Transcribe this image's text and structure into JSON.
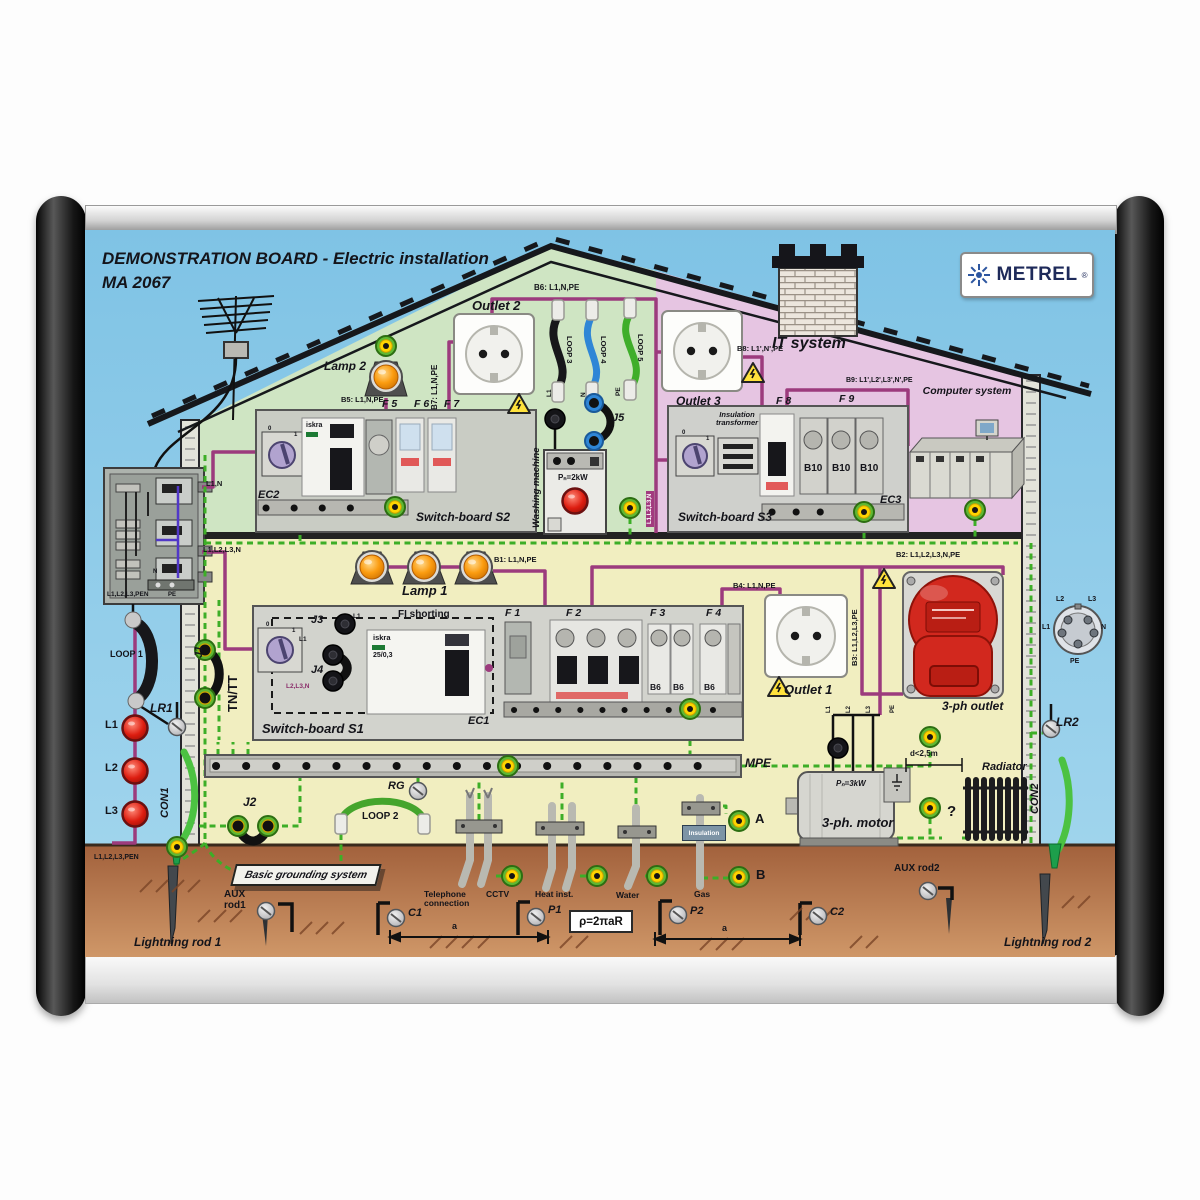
{
  "header": {
    "title": "DEMONSTRATION BOARD  -  Electric installation",
    "model": "MA 2067",
    "brand": "METREL",
    "registered": "®"
  },
  "attic": {
    "outlet2": "Outlet 2",
    "b6": "B6: L1,N,PE",
    "b7": "B7: L1,N,PE",
    "loop3": "LOOP 3",
    "loop4": "LOOP 4",
    "loop5": "LOOP 5",
    "wire_l1": "L1",
    "wire_n": "N",
    "wire_pe": "PE",
    "j5": "J5",
    "lamp2": "Lamp 2",
    "b5": "B5: L1,N,PE",
    "f5": "F 5",
    "f6": "F 6",
    "f7": "F 7",
    "ec2": "EC2",
    "switchboard_s2": "Switch-board S2",
    "washing_machine": "Washing machine",
    "washer_power": "Pₙ=2kW",
    "riser": "L1,L2,L3,N"
  },
  "it_room": {
    "title": "IT system",
    "outlet3": "Outlet 3",
    "b8": "B8: L1',N',PE",
    "b9": "B9: L1',L2',L3',N',PE",
    "f8": "F 8",
    "f9": "F 9",
    "insulation_transformer": "Insulation transformer",
    "b10_1": "B10",
    "b10_2": "B10",
    "b10_3": "B10",
    "ec3": "EC3",
    "switchboard_s3": "Switch-board S3",
    "computer_system": "Computer system"
  },
  "floor": {
    "lamp1": "Lamp 1",
    "b1": "B1: L1,N,PE",
    "f1": "F 1",
    "f2": "F 2",
    "f3": "F 3",
    "f4": "F 4",
    "fi_shorting": "FI shorting",
    "j1": "J1",
    "tn_tt": "TN/TT",
    "j3": "J3",
    "j4": "J4",
    "l1_a": "L1",
    "l1_b": "L1",
    "l2l3n": "L2,L3,N",
    "switchboard_s1": "Switch-board S1",
    "ec1": "EC1",
    "b6_breakers": [
      "B6",
      "B6",
      "B6"
    ],
    "b2": "B2: L1,L2,L3,N,PE",
    "b3": "B3: L1,L2,L3,PE",
    "b4": "B4: L1,N,PE",
    "outlet1": "Outlet 1",
    "three_ph_outlet": "3-ph outlet",
    "mpe": "MPE",
    "motor_power": "Pₙ=3kW",
    "motor": "3-ph. motor",
    "distance": "d<2,5m",
    "radiator": "Radiator",
    "question": "?",
    "motor_wires": [
      "L1",
      "L2",
      "L3",
      "PE"
    ]
  },
  "devices": {
    "iskra": "iskra",
    "rcd_rating": "25/0,3",
    "rotary_off": "0",
    "rotary_on": "1"
  },
  "supply": {
    "l1n": "L1,N",
    "l123n": "L1,L2,L3,N",
    "l123pen": "L1,L2,L3,PEN",
    "pe": "PE",
    "n": "N",
    "loop1": "LOOP 1",
    "lr1": "LR1",
    "lamp_l1": "L1",
    "lamp_l2": "L2",
    "lamp_l3": "L3",
    "con1": "CON1",
    "cable": "L1,L2,L3,PEN"
  },
  "right_side": {
    "pin_l1": "L1",
    "pin_l2": "L2",
    "pin_l3": "L3",
    "pin_n": "N",
    "pin_pe": "PE",
    "lr2": "LR2",
    "con2": "CON2"
  },
  "ground": {
    "j2": "J2",
    "loop2": "LOOP 2",
    "rg": "RG",
    "basic": "Basic grounding system",
    "telephone": "Telephone connection",
    "cctv": "CCTV",
    "heat": "Heat inst.",
    "water": "Water",
    "gas": "Gas",
    "insulation": "Insulation",
    "jack_a": "A",
    "jack_b": "B",
    "aux_rod1": "AUX rod1",
    "aux_rod2": "AUX rod2",
    "lightning_rod1": "Lightning rod 1",
    "lightning_rod2": "Lightning rod 2",
    "c1": "C1",
    "p1": "P1",
    "p2": "P2",
    "c2": "C2",
    "formula": "ρ=2πaR",
    "dim_a1": "a",
    "dim_a2": "a"
  },
  "colors": {
    "sky": "#84c7e6",
    "room_green": "#cfe5c3",
    "room_pink": "#e6c5e2",
    "room_yellow": "#f1eec0",
    "earth": "#b06c46",
    "phase_wire": "#9c3b7d",
    "pe_wire": "#3dae27",
    "outlet_red": "#d2281e",
    "brand_blue": "#2d56a0"
  }
}
